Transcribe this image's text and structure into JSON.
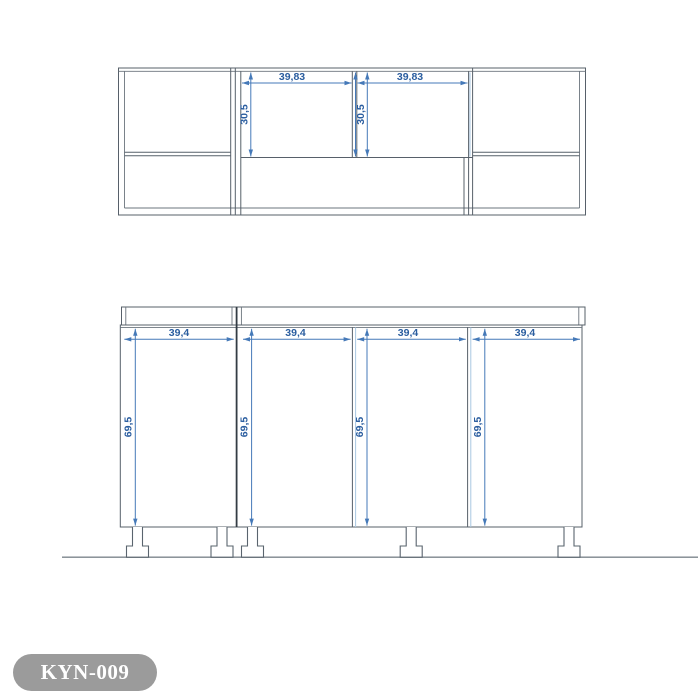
{
  "product_label": {
    "code": "KYN-009",
    "bg_color": "#9b9b9b",
    "text_color": "#ffffff"
  },
  "drawing_colors": {
    "structure_line": "#57606a",
    "dimension_blue": "#4579b8",
    "dimension_text_blue": "#2a5d9f"
  },
  "upper_cabinet": {
    "view": "wall-cabinet-front-elevation",
    "opening_width_labels": [
      "39,83",
      "39,83"
    ],
    "opening_height_labels": [
      "30,5",
      "30,5"
    ]
  },
  "base_cabinet": {
    "view": "base-cabinet-front-elevation",
    "door_width_labels": [
      "39,4",
      "39,4",
      "39,4",
      "39,4"
    ],
    "door_height_labels": [
      "69,5",
      "69,5",
      "69,5",
      "69,5"
    ]
  }
}
